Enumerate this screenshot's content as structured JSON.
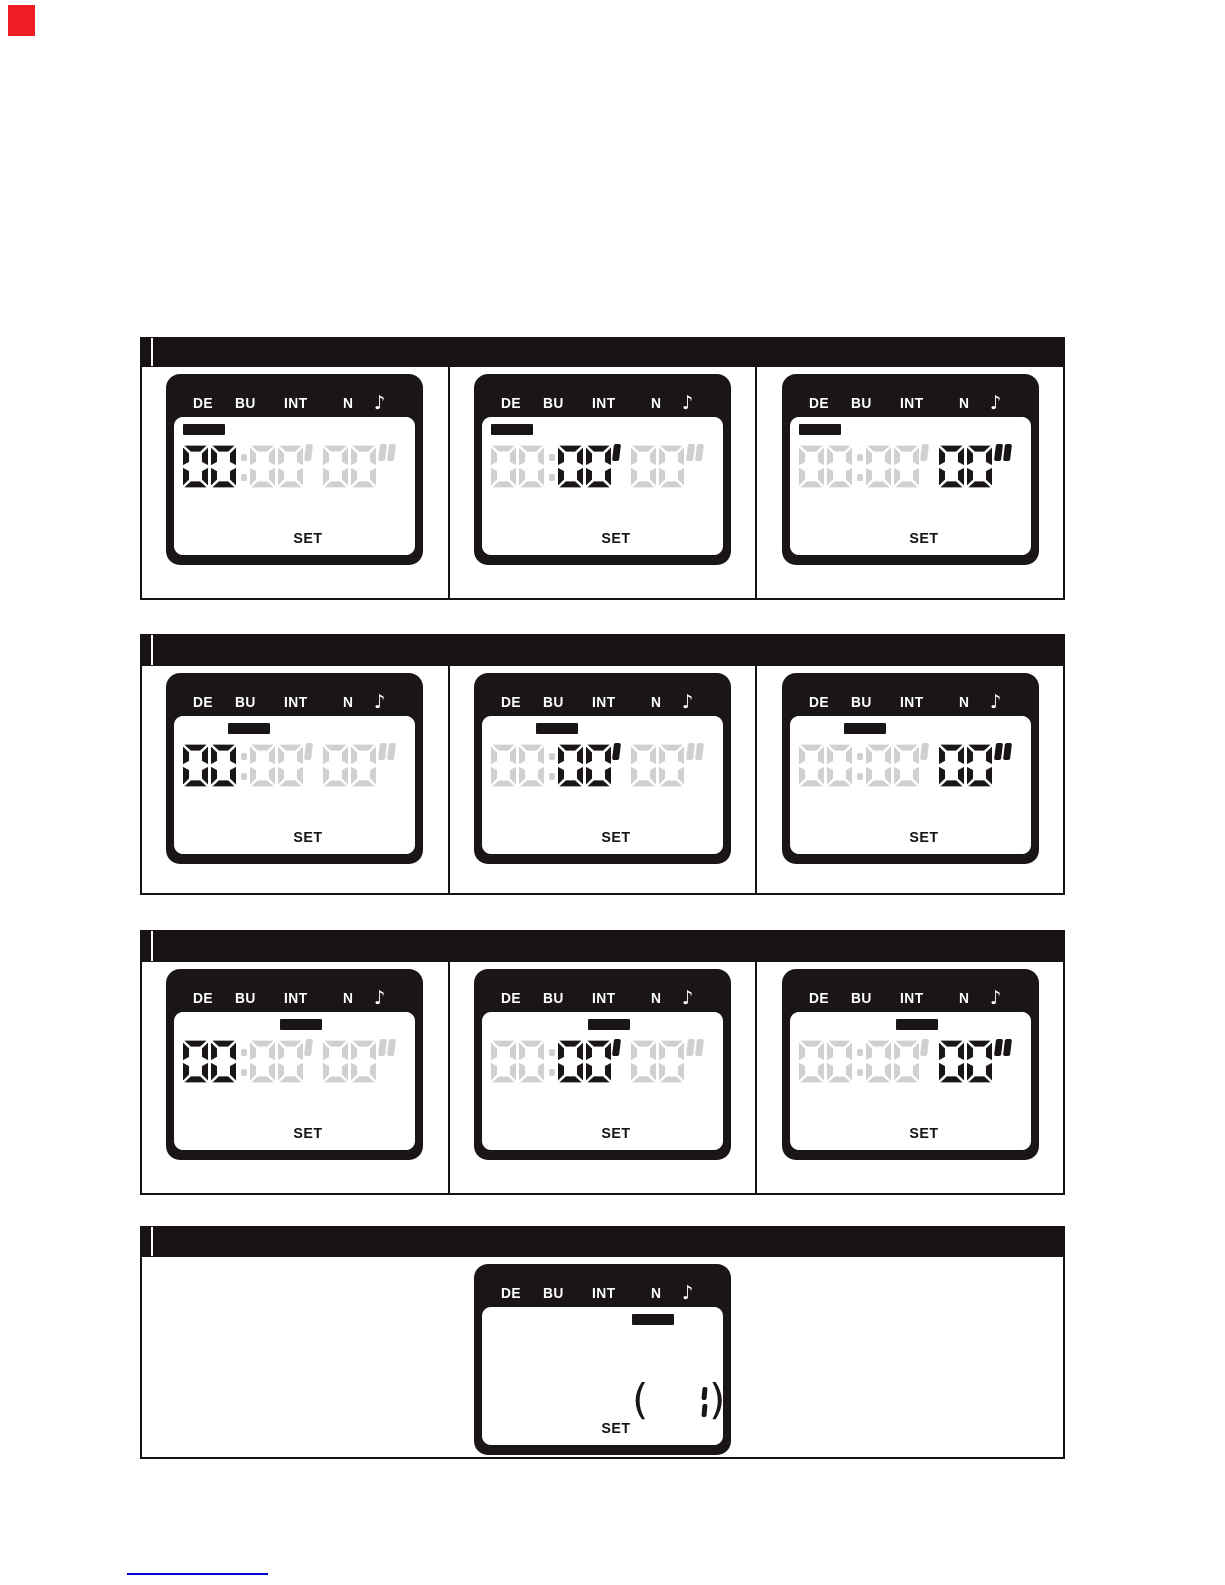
{
  "page": {
    "corner_marker_color": "#ee1c25",
    "footer_underline_color": "#0000c8"
  },
  "lcd": {
    "status_labels": [
      {
        "label": "DE"
      },
      {
        "label": "BU"
      },
      {
        "label": "INT"
      },
      {
        "label": "N"
      },
      {
        "label": "♪",
        "icon": "note-icon"
      }
    ],
    "set_label": "SET",
    "display": {
      "hours": "00",
      "separator": ":",
      "minutes": "00",
      "minute_mark": "'",
      "seconds": "00",
      "second_mark": "\""
    },
    "colors": {
      "shell": "#1a1617",
      "screen": "#ffffff",
      "active": "#1a1617",
      "inactive": "#d0d0d0"
    }
  },
  "sections": [
    {
      "title": "",
      "panels": [
        {
          "indicator": "DE",
          "active_field": "hours"
        },
        {
          "indicator": "DE",
          "active_field": "minutes"
        },
        {
          "indicator": "DE",
          "active_field": "seconds"
        }
      ]
    },
    {
      "title": "",
      "panels": [
        {
          "indicator": "BU",
          "active_field": "hours"
        },
        {
          "indicator": "BU",
          "active_field": "minutes"
        },
        {
          "indicator": "BU",
          "active_field": "seconds"
        }
      ]
    },
    {
      "title": "",
      "panels": [
        {
          "indicator": "INT",
          "active_field": "hours"
        },
        {
          "indicator": "INT",
          "active_field": "minutes"
        },
        {
          "indicator": "INT",
          "active_field": "seconds"
        }
      ]
    },
    {
      "title": "",
      "panels": [
        {
          "indicator": "N",
          "active_field": "cycles",
          "cycles_display": {
            "open_bracket": "(",
            "value": "1",
            "close_bracket": ")"
          }
        }
      ]
    }
  ]
}
